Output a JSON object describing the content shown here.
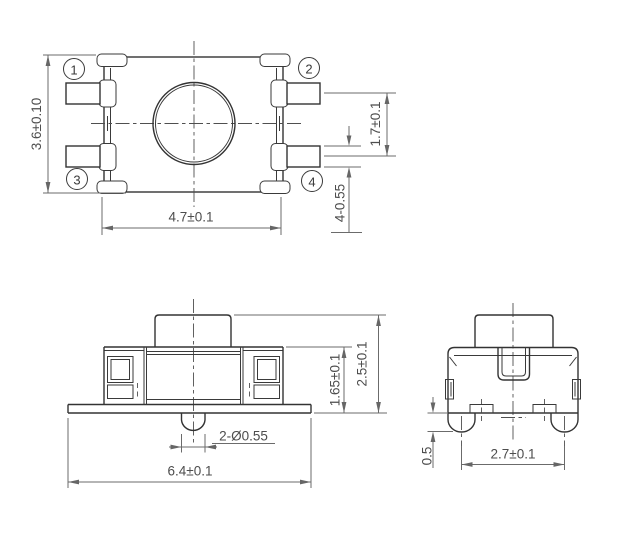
{
  "drawing": {
    "type": "technical-drawing",
    "component": "tactile switch outline drawing",
    "colors": {
      "background": "#ffffff",
      "geometry_line": "#333333",
      "dimension_line": "#6b6b6b",
      "dimension_text": "#4d4d4d"
    },
    "views": {
      "top": {
        "pins": [
          {
            "label": "1"
          },
          {
            "label": "2"
          },
          {
            "label": "3"
          },
          {
            "label": "4"
          }
        ],
        "dims": {
          "height": "3.6±0.10",
          "width": "4.7±0.1",
          "pin_spacing": "1.7±0.1",
          "pin_width": "4-0.55"
        }
      },
      "front": {
        "dims": {
          "peg": "2-Ø0.55",
          "total_width": "6.4±0.1",
          "body_height": "1.65±0.1",
          "total_height": "2.5±0.1"
        }
      },
      "side": {
        "dims": {
          "leg_spacing": "2.7±0.1",
          "leg_protrusion": "0.5"
        }
      }
    }
  }
}
